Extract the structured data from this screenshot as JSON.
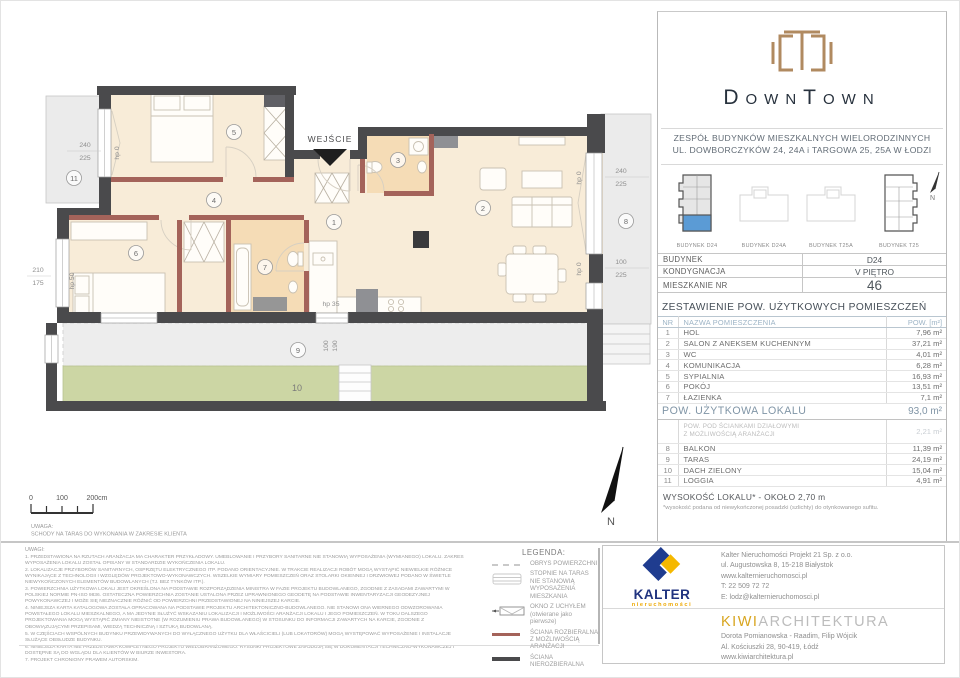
{
  "brand": {
    "name": "DownTown",
    "subtitle1": "ZESPÓŁ BUDYNKÓW MIESZKALNYCH WIELORODZINNYCH",
    "subtitle2": "UL. DOWBORCZYKÓW 24, 24A i TARGOWA 25, 25A W ŁODZI"
  },
  "site_plan": {
    "buildings": [
      {
        "label": "BUDYNEK D24"
      },
      {
        "label": "BUDYNEK D24A"
      },
      {
        "label": "BUDYNEK T25A"
      },
      {
        "label": "BUDYNEK T25"
      }
    ],
    "north": "N"
  },
  "unit": {
    "rows": [
      {
        "label": "BUDYNEK",
        "value": "D24"
      },
      {
        "label": "KONDYGNACJA",
        "value": "V PIĘTRO"
      },
      {
        "label": "MIESZKANIE NR",
        "value": "46"
      }
    ]
  },
  "areas": {
    "title": "ZESTAWIENIE POW. UŻYTKOWYCH POMIESZCZEŃ",
    "headers": {
      "nr": "NR",
      "name": "NAZWA POMIESZCZENIA",
      "pow": "POW. [m²]"
    },
    "rooms": [
      {
        "nr": "1",
        "name": "HOL",
        "pow": "7,96 m²"
      },
      {
        "nr": "2",
        "name": "SALON Z ANEKSEM KUCHENNYM",
        "pow": "37,21 m²"
      },
      {
        "nr": "3",
        "name": "WC",
        "pow": "4,01 m²"
      },
      {
        "nr": "4",
        "name": "KOMUNIKACJA",
        "pow": "6,28 m²"
      },
      {
        "nr": "5",
        "name": "SYPIALNIA",
        "pow": "16,93 m²"
      },
      {
        "nr": "6",
        "name": "POKÓJ",
        "pow": "13,51 m²"
      },
      {
        "nr": "7",
        "name": "ŁAZIENKA",
        "pow": "7,1 m²"
      }
    ],
    "total_label": "POW. UŻYTKOWA LOKALU",
    "total_value": "93,0 m²",
    "partition": {
      "line1": "POW. POD ŚCIANKAMI DZIAŁOWYMI",
      "line2": "Z MOŻLIWOŚCIĄ ARANŻACJI",
      "pow": "2,21 m²"
    },
    "extras": [
      {
        "nr": "8",
        "name": "BALKON",
        "pow": "11,39 m²"
      },
      {
        "nr": "9",
        "name": "TARAS",
        "pow": "24,19 m²"
      },
      {
        "nr": "10",
        "name": "DACH ZIELONY",
        "pow": "15,04 m²"
      },
      {
        "nr": "11",
        "name": "LOGGIA",
        "pow": "4,91 m²"
      }
    ],
    "height_note": "WYSOKOŚĆ LOKALU* - OKOŁO 2,70 m",
    "height_footnote": "*wysokość podana od niewykończonej posadzki (szlichty) do otynkowanego sufitu."
  },
  "plan": {
    "entrance": "WEJŚCIE",
    "north": "N",
    "rooms": {
      "n1": "1",
      "n2": "2",
      "n3": "3",
      "n4": "4",
      "n5": "5",
      "n6": "6",
      "n7": "7",
      "n8": "8",
      "n9": "9",
      "n10": "10",
      "n11": "11"
    },
    "dims": {
      "d240": "240",
      "d225": "225",
      "d210": "210",
      "d175": "175",
      "d100": "100",
      "d190": "190",
      "hp0": "hp 0",
      "hp35": "hp 35",
      "hp50": "hp 50"
    },
    "scale": {
      "t0": "0",
      "t1": "100",
      "t2": "200cm"
    },
    "note1": "UWAGA:",
    "note2": "SCHODY NA TARAS DO WYKONANIA W ZAKRESIE KLIENTA"
  },
  "legend": {
    "title": "LEGENDA:",
    "items": [
      {
        "label": "OBRYS POWIERZCHNI"
      },
      {
        "label": "STOPNIE NA TARAS NIE STANOWIĄ WYPOSAŻENIA MIESZKANIA"
      },
      {
        "label": "OKNO Z UCHYŁEM (otwierane jako pierwsze)"
      },
      {
        "label": "ŚCIANA ROZBIERALNA Z MOŻLIWOŚCIĄ ARANŻACJI"
      },
      {
        "label": "ŚCIANA NIEROZBIERALNA"
      }
    ]
  },
  "notes": {
    "title": "UWAGI:",
    "items": [
      "1. PRZEDSTAWIONA NA RZUTACH ARANŻACJA MA CHARAKTER PRZYKŁADOWY. UMEBLOWANIE I PRZYBORY SANITARNE NIE STANOWIĄ WYPOSAŻENIA (WYMIANEGO) LOKALU. ZAKRES WYPOSAŻENIA LOKALU ZOSTAŁ OPISANY W STANDARDZIE WYKOŃCZENIA LOKALU.",
      "2. LOKALIZACJE PRZYBORÓW SANITARNYCH, OSPRZĘTU ELEKTRYCZNEGO ITP. PODANO ORIENTACYJNIE. W TRAKCIE REALIZACJI ROBÓT MOGĄ WYSTĄPIĆ NIEWIELKIE RÓŻNICE WYNIKAJĄCE Z TECHNOLOGII I WZGLĘDÓW PROJEKTOWO-WYKONAWCZYCH. WSZELKIE WYMIARY POMIESZCZEŃ ORAZ STOLARKI OKIENNEJ I DRZWIOWEJ PODANO W ŚWIETLE NIEWYKOŃCZONYCH ELEMENTÓW BUDOWLANYCH (TJ. BEZ TYNKÓW ITP.).",
      "3. POWIERZCHNIA UŻYTKOWA LOKALI JEST OKREŚLONA NA PODSTAWIE ROZPORZĄDZENIA MINISTRA W FAZIE PROJEKTU BUDOWLANEGO, ZGODNIE Z ZASADAMI ZAWARTYMI W POLSKIEJ NORMIE PN-ISO 9836. OSTATECZNA POWIERZCHNIA ZOSTANIE USTALONA PRZEZ UPRAWNIONEGO GEODETĘ NA PODSTAWIE INWENTARYZACJI GEODEZYJNEJ POWYKONAWCZEJ I MOŻE SIĘ NIEZNACZNIE RÓŻNIĆ OD POWIERZCHNI PRZEDSTAWIONEJ NA NINIEJSZEJ KARCIE.",
      "4. NINIEJSZA KARTA KATALOGOWA ZOSTAŁA OPRACOWANA NA PODSTAWIE PROJEKTU ARCHITEKTONICZNO-BUDOWLANEGO. NIE STANOWI ONA WIERNEGO ODWZOROWANIA POWSTAŁEGO LOKALU MIESZKALNEGO, A MA JEDYNIE SŁUŻYĆ WSKAZANIU LOKALIZACJI I MOŻLIWOŚCI ARANŻACJI LOKALU I JEGO POMIESZCZEŃ. W TOKU DALSZEGO PROJEKTOWANIA MOGĄ WYSTĄPIĆ ZMIANY NIEISTOTNE (W ROZUMIENIU PRAWA BUDOWLANEGO) W STOSUNKU DO INFORMACJI ZAWARTYCH NA KARCIE, ZGODNIE Z OBOWIĄZUJĄCYMI PRZEPISAMI, WIEDZĄ TECHNICZNĄ I SZTUKĄ BUDOWLANĄ.",
      "5. W CZĘŚCIACH WSPÓLNYCH BUDYNKU PRZEWIDYWANYCH DO WYŁĄCZNEGO UŻYTKU DLA WŁAŚCICIELI (LUB LOKATORÓW) MOGĄ WYSTĘPOWAĆ WYPOSAŻENIE I INSTALACJE SŁUŻĄCE OBSŁUDZE BUDYNKU.",
      "6. NINIEJSZA KARTA NIE PRZEDSTAWIA KOMPLETNEGO PROJEKTU WIELOBRANŻOWEGO. RYSUNKI PROJEKTOWE ZNAJDUJĄ SIĘ W DOKUMENTACJI TECHNICZNO-WYKONAWCZEJ I DOSTĘPNE SĄ DO WGLĄDU DLA KLIENTÓW W BIURZE INWESTORA.",
      "7. PROJEKT CHRONIONY PRAWEM AUTORSKIM."
    ]
  },
  "kalter": {
    "name": "KALTER",
    "tagline": "nieruchomości",
    "lines": [
      "Kalter Nieruchomości Projekt 21 Sp. z o.o.",
      "ul. Augustowska 8, 15-218 Białystok",
      "www.kalternieruchomosci.pl",
      "T: 22 509 72 72",
      "E: lodz@kalternieruchomosci.pl"
    ]
  },
  "kiwi": {
    "name1": "KIWI",
    "name2": "ARCHITEKTURA",
    "lines": [
      "Dorota Pomianowska - Raadim, Filip Wójcik",
      "Al. Kościuszki 28, 90-419, Łódź",
      "www.kiwiarchitektura.pl"
    ]
  },
  "colors": {
    "wall": "#4a4a4c",
    "removable_wall": "#a4635a",
    "interior": "#f8ecd8",
    "wet_room": "#f5dcb6",
    "outdoor_gray": "#ebebeb",
    "green_roof": "#ccd6a4",
    "unit_highlight": "#5b9bd5",
    "brand_bronze": "#b08a60",
    "brand_navy": "#27313d",
    "kalter_blue": "#20337f",
    "kalter_yellow": "#f5b800",
    "kiwi_gold": "#d8a51e",
    "table_header_blue": "#9db4c6",
    "table_total_blue": "#8095a6"
  }
}
